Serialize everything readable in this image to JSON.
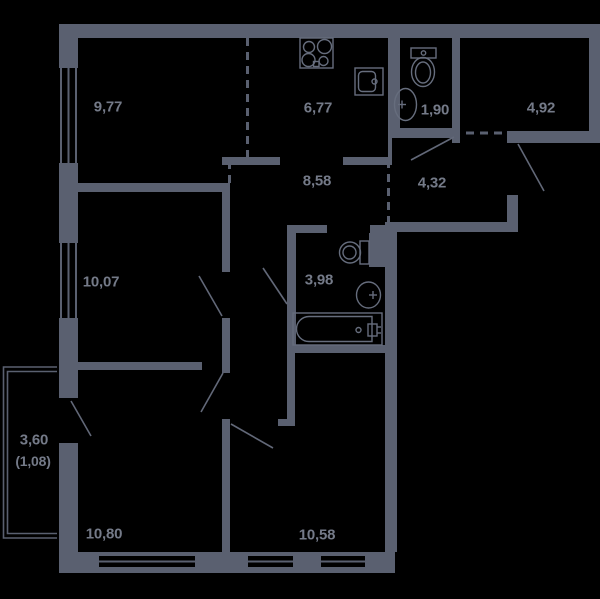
{
  "plan_type": "apartment-floor-plan",
  "colors": {
    "background": "#000000",
    "walls": "#5a6070",
    "fixture_lines": "#666d7d",
    "labels": "#747a88"
  },
  "rooms": [
    {
      "name": "living-room",
      "label": "9,77",
      "cx": 108,
      "cy": 107
    },
    {
      "name": "kitchen",
      "label": "6,77",
      "cx": 318,
      "cy": 108
    },
    {
      "name": "wc",
      "label": "1,90",
      "cx": 435,
      "cy": 110
    },
    {
      "name": "room-4-92",
      "label": "4,92",
      "cx": 541,
      "cy": 108
    },
    {
      "name": "corridor",
      "label": "8,58",
      "cx": 317,
      "cy": 181
    },
    {
      "name": "entry-hall",
      "label": "4,32",
      "cx": 432,
      "cy": 183
    },
    {
      "name": "bedroom-1",
      "label": "10,07",
      "cx": 101,
      "cy": 282
    },
    {
      "name": "bathroom",
      "label": "3,98",
      "cx": 319,
      "cy": 280
    },
    {
      "name": "balcony",
      "label": "3,60",
      "label_secondary": "(1,08)",
      "cx": 34,
      "cy": 440
    },
    {
      "name": "bedroom-2",
      "label": "10,80",
      "cx": 104,
      "cy": 534
    },
    {
      "name": "bedroom-3",
      "label": "10,58",
      "cx": 317,
      "cy": 535
    }
  ],
  "fixtures": [
    "stove-icon",
    "kitchen-sink-icon",
    "toilet-icon",
    "wash-basin-icon",
    "bathtub-icon",
    "vent-duct"
  ]
}
